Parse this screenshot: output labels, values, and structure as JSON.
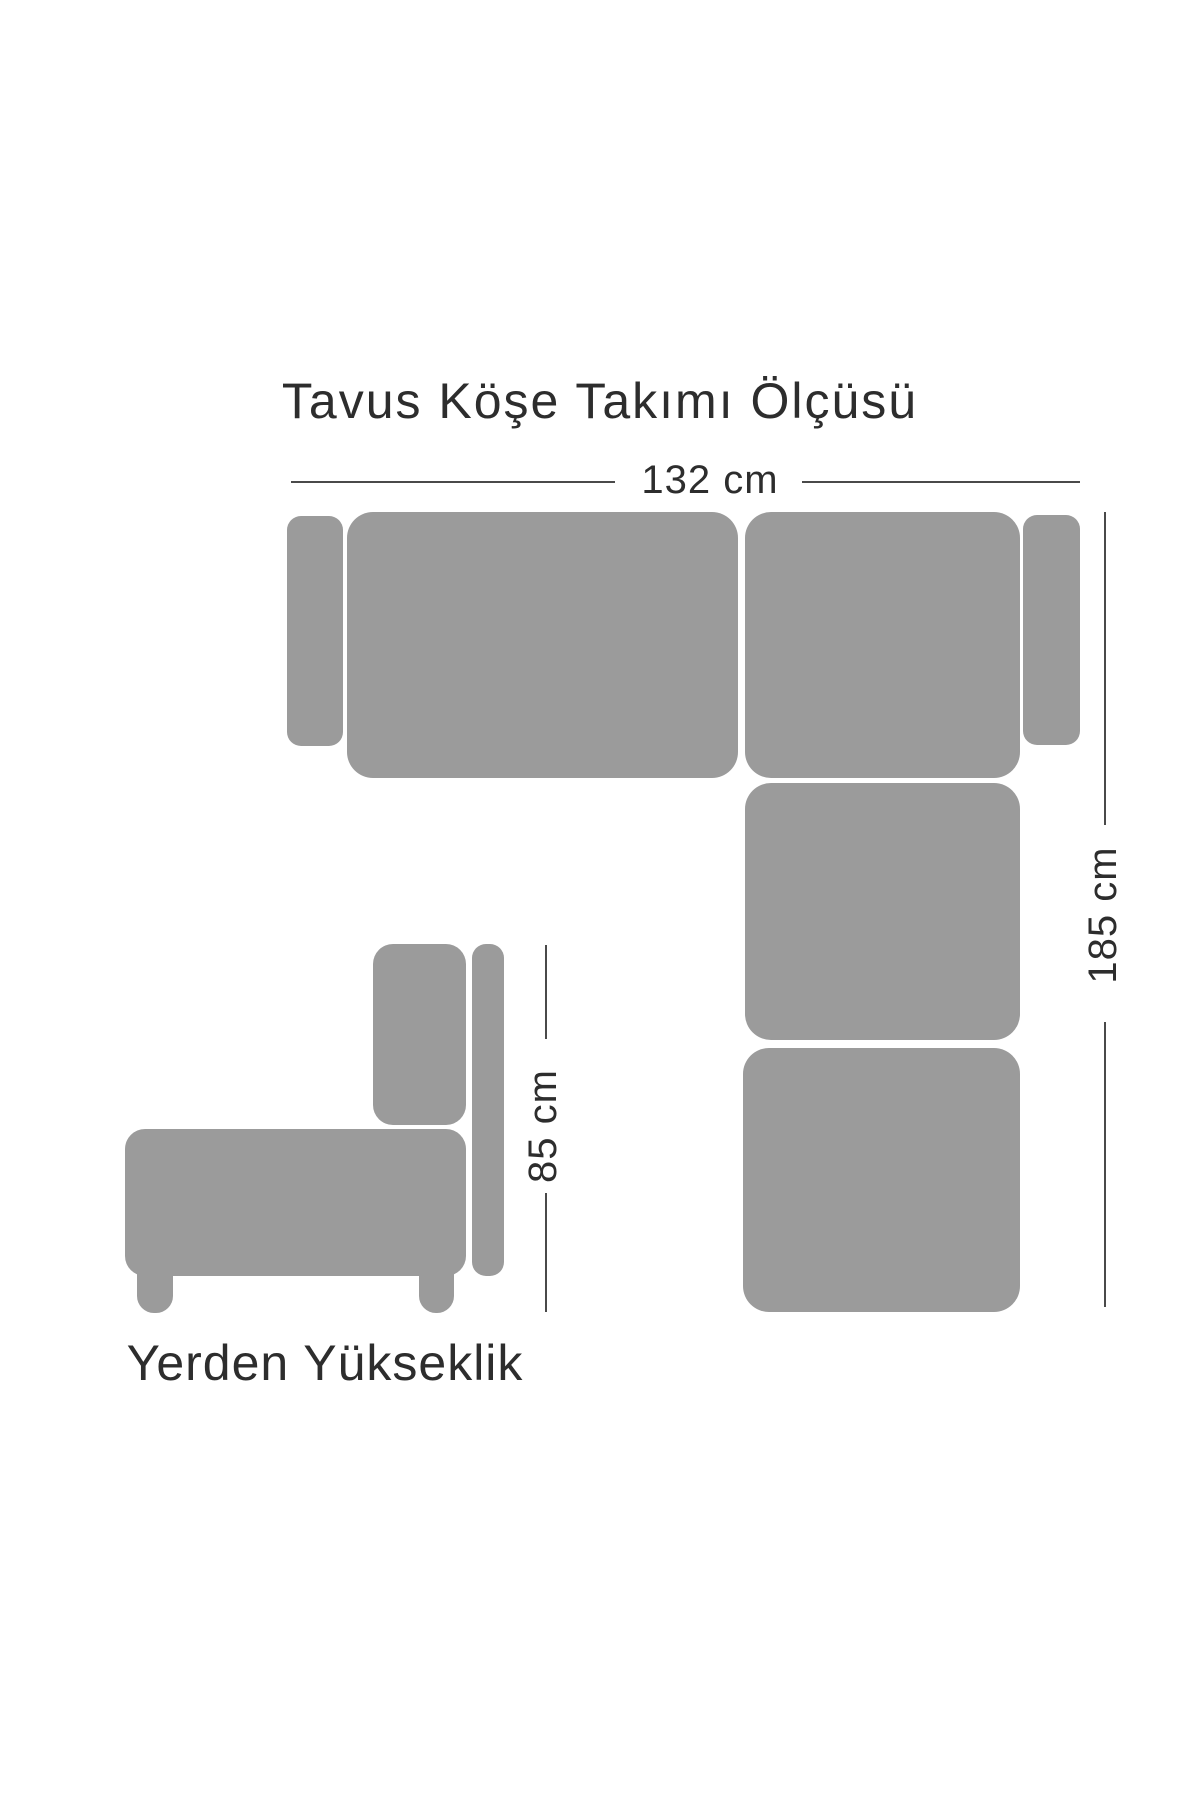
{
  "title": "Tavus Köşe Takımı Ölçüsü",
  "diagram": {
    "type": "furniture-dimension-diagram",
    "product": "Tavus Köşe Takımı",
    "views": {
      "plan_view": {
        "description": "top-down view of L-shaped corner sofa",
        "width_label": "132 cm",
        "depth_label": "185 cm"
      },
      "side_view": {
        "description": "side elevation of sofa",
        "height_label": "85 cm",
        "caption": "Yerden Yükseklik"
      }
    }
  },
  "labels": {
    "width": "132 cm",
    "depth": "185 cm",
    "height": "85 cm",
    "footer": "Yerden Yükseklik"
  },
  "colors": {
    "sofa_fill": "#9b9b9b",
    "dimension_line": "#4a4a4a",
    "text": "#2d2d2d",
    "background": "#ffffff"
  }
}
